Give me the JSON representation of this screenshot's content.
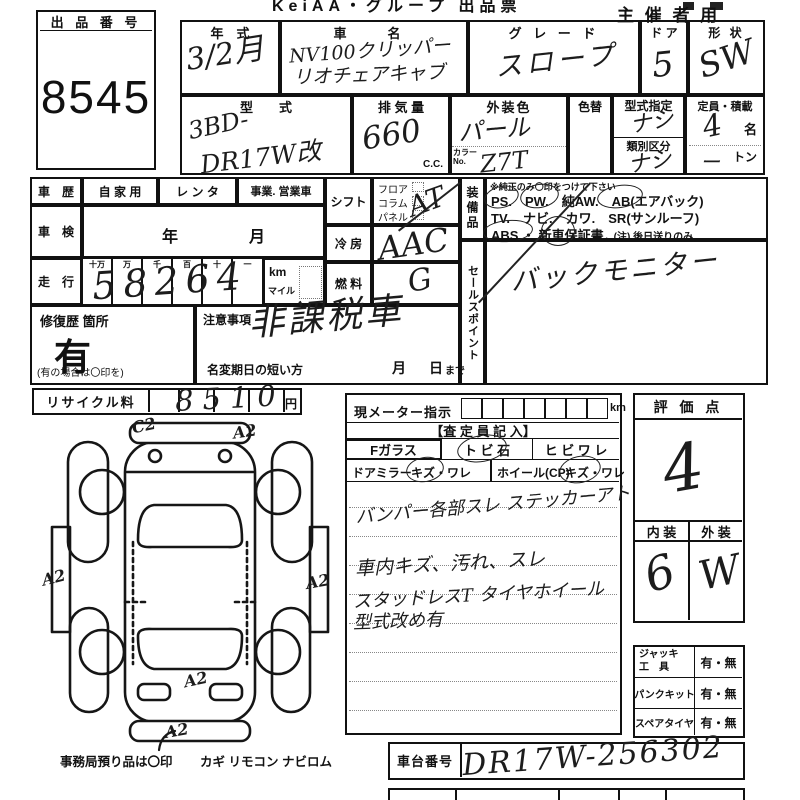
{
  "header": {
    "logo": "KeiAA・グループ 出品票",
    "audience": "主 催 者 用"
  },
  "lot": {
    "label": "出 品 番 号",
    "number": "8545"
  },
  "info": {
    "year_label": "年　式",
    "year_value": "3/2月",
    "name_label": "車　名",
    "name_line1": "NV100クリッパー",
    "name_line2": "リオチェアキャブ",
    "grade_label": "グ レ ー ド",
    "grade_value": "スロープ",
    "door_label": "ド ア",
    "door_value": "5",
    "shape_label": "形 状",
    "shape_value": "SW",
    "model_label": "型　　式",
    "model_line1": "3BD-",
    "model_line2": "DR17W改",
    "disp_label": "排 気 量",
    "disp_value": "660",
    "disp_unit": "C.C.",
    "color_label": "外装色",
    "color_value": "パール",
    "color_no_l1": "カラー",
    "color_no_l2": "No.",
    "color_no_value": "Z7T",
    "recolor_label": "色替",
    "type_label": "型式指定",
    "type_value": "ナシ",
    "class_label": "類別区分",
    "class_value": "ナシ",
    "capacity_label": "定員・積載",
    "capacity_value": "4",
    "capacity_unit": "名",
    "load_value": "ー",
    "load_unit": "トン"
  },
  "history": {
    "label": "車　歴",
    "private": "自 家 用",
    "rental": "レ ン タ",
    "business": "事業. 営業車",
    "shaken_label": "車　検",
    "shaken_year": "年",
    "shaken_month": "月",
    "mileage_label": "走　行",
    "digit_headers": [
      "十万",
      "万",
      "千",
      "百",
      "十",
      "一"
    ],
    "mileage_value": "58264",
    "km": "km",
    "mile": "マイル",
    "shift_label": "シフト",
    "shift_opt1": "フロア",
    "shift_opt2": "コラム",
    "shift_opt3": "パネル",
    "shift_value": "AT",
    "ac_label": "冷 房",
    "ac_value": "AAC",
    "fuel_label": "燃 料",
    "fuel_value": "G",
    "repair_label": "修復歴 箇所",
    "repair_value": "有",
    "repair_note": "(有の場合は〇印を)",
    "caution_label": "注意事項",
    "caution_value": "非課税車",
    "rename_label": "名変期日の短い方",
    "rename_month": "月",
    "rename_day": "日",
    "rename_suffix": "まで"
  },
  "equipment": {
    "label": "装備品",
    "note": "※純正のみ〇印をつけて下さい",
    "line1": "PS.　PW.　純AW.　AB(エアバック)",
    "line2": "TV.　ナビ.　カワ.　SR(サンルーフ)",
    "line3a": "ABS ・ 新車保証書",
    "line3b": "←(注) 後日送りのみ"
  },
  "sales": {
    "label": "セールスポイント",
    "value": "バックモニター"
  },
  "recycle": {
    "label": "リサイクル料",
    "value": "8510",
    "unit": "円"
  },
  "diagram": {
    "codes": [
      "C2",
      "A2",
      "A2",
      "A2",
      "A2",
      "A2"
    ]
  },
  "assess": {
    "meter_label": "現メーター指示",
    "meter_unit": "km",
    "title": "【査 定 員 記 入】",
    "fglass": "Fガラス",
    "stone": "ト ビ 石",
    "crack": "ヒ ビ ワ レ",
    "mirror_label": "ドアミラー",
    "mirror_kind": "キズ・ワレ",
    "wheel_label": "ホイール(CP)",
    "wheel_kind": "キズ・ワレ",
    "note1": "バンパー各部スレ ステッカーアト",
    "note2": "車内キズ、汚れ、スレ",
    "note3": "スタッドレスT タイヤホイール",
    "note4": "型式改め有"
  },
  "score": {
    "label": "評 価 点",
    "value": "4",
    "interior_label": "内 装",
    "exterior_label": "外 装",
    "interior_value": "6",
    "exterior_value": "W"
  },
  "tools": {
    "jack_l1": "ジャッキ",
    "jack_l2": "工　具",
    "jack_opt": "有・無",
    "pank_label": "パンクキット",
    "pank_opt": "有・無",
    "spare_label": "スペアタイヤ",
    "spare_opt": "有・無"
  },
  "chassis": {
    "label": "車台番号",
    "value": "DR17W-256302"
  },
  "office": {
    "note": "事務局預り品は〇印",
    "items": "カギ  リモコン  ナビロム"
  }
}
